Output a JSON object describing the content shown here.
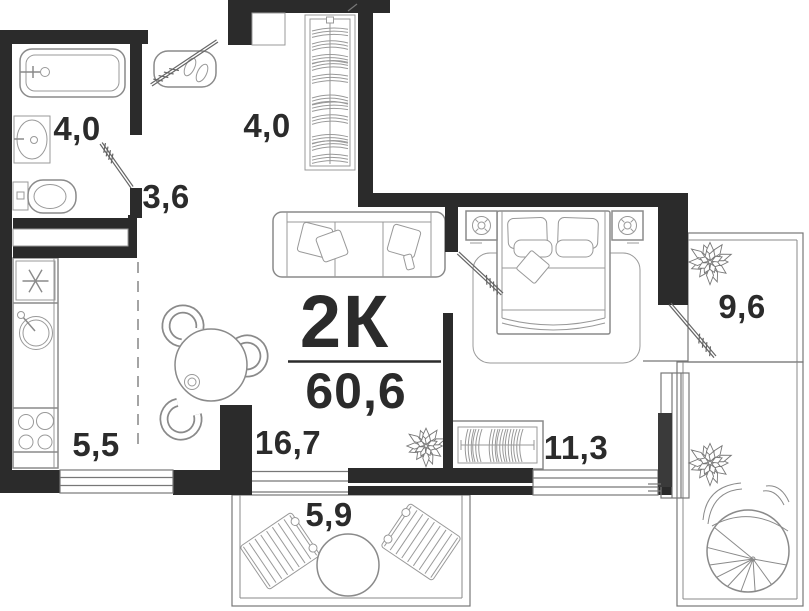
{
  "plan": {
    "apartment_type": "2К",
    "total_area": "60,6",
    "rooms": {
      "bathroom": "4,0",
      "hallway": "3,6",
      "closet": "4,0",
      "kitchen": "5,5",
      "living": "16,7",
      "balcony": "5,9",
      "bedroom": "11,3",
      "loggia": "9,6"
    },
    "colors": {
      "wall": "#2b2b2b",
      "furniture_line": "#8a8a8a",
      "window_panel": "#3a3a3a",
      "background": "#ffffff",
      "text": "#2b2b2b"
    }
  }
}
